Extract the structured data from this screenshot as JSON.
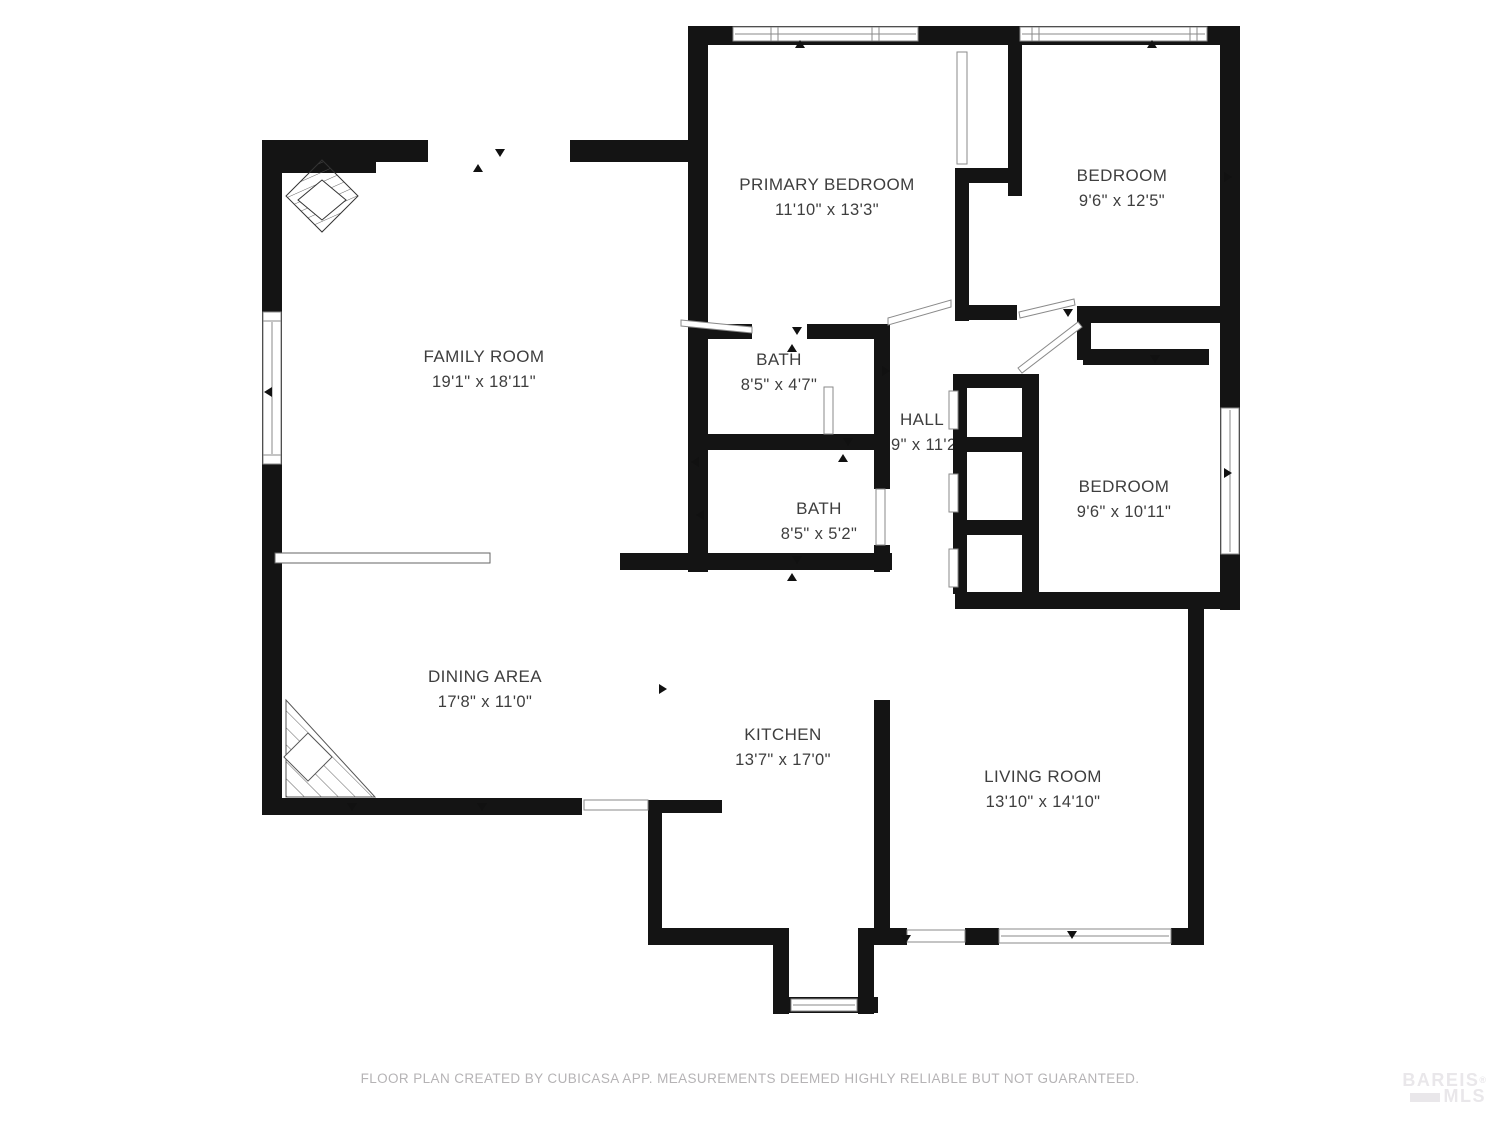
{
  "plan": {
    "rooms": [
      {
        "id": "family-room",
        "name": "FAMILY ROOM",
        "dims": "19'1\" x 18'11\""
      },
      {
        "id": "primary-bedroom",
        "name": "PRIMARY BEDROOM",
        "dims": "11'10\" x 13'3\""
      },
      {
        "id": "bedroom-top",
        "name": "BEDROOM",
        "dims": "9'6\" x 12'5\""
      },
      {
        "id": "bath-upper",
        "name": "BATH",
        "dims": "8'5\" x 4'7\""
      },
      {
        "id": "hall",
        "name": "HALL",
        "dims": "'9\" x 11'2"
      },
      {
        "id": "bath-lower",
        "name": "BATH",
        "dims": "8'5\" x 5'2\""
      },
      {
        "id": "bedroom-right",
        "name": "BEDROOM",
        "dims": "9'6\" x 10'11\""
      },
      {
        "id": "dining-area",
        "name": "DINING AREA",
        "dims": "17'8\" x 11'0\""
      },
      {
        "id": "kitchen",
        "name": "KITCHEN",
        "dims": "13'7\" x 17'0\""
      },
      {
        "id": "living-room",
        "name": "LIVING ROOM",
        "dims": "13'10\" x 14'10\""
      }
    ],
    "footer": "FLOOR PLAN CREATED BY CUBICASA APP. MEASUREMENTS DEEMED HIGHLY RELIABLE BUT NOT GUARANTEED.",
    "watermark": {
      "line1": "BAREIS",
      "registered": "®",
      "line2": "MLS"
    },
    "colors": {
      "wall": "#141414",
      "background": "#ffffff",
      "label": "#3e3e3e",
      "footer": "#b5b3b5",
      "watermark": "#e9e7ea"
    }
  }
}
